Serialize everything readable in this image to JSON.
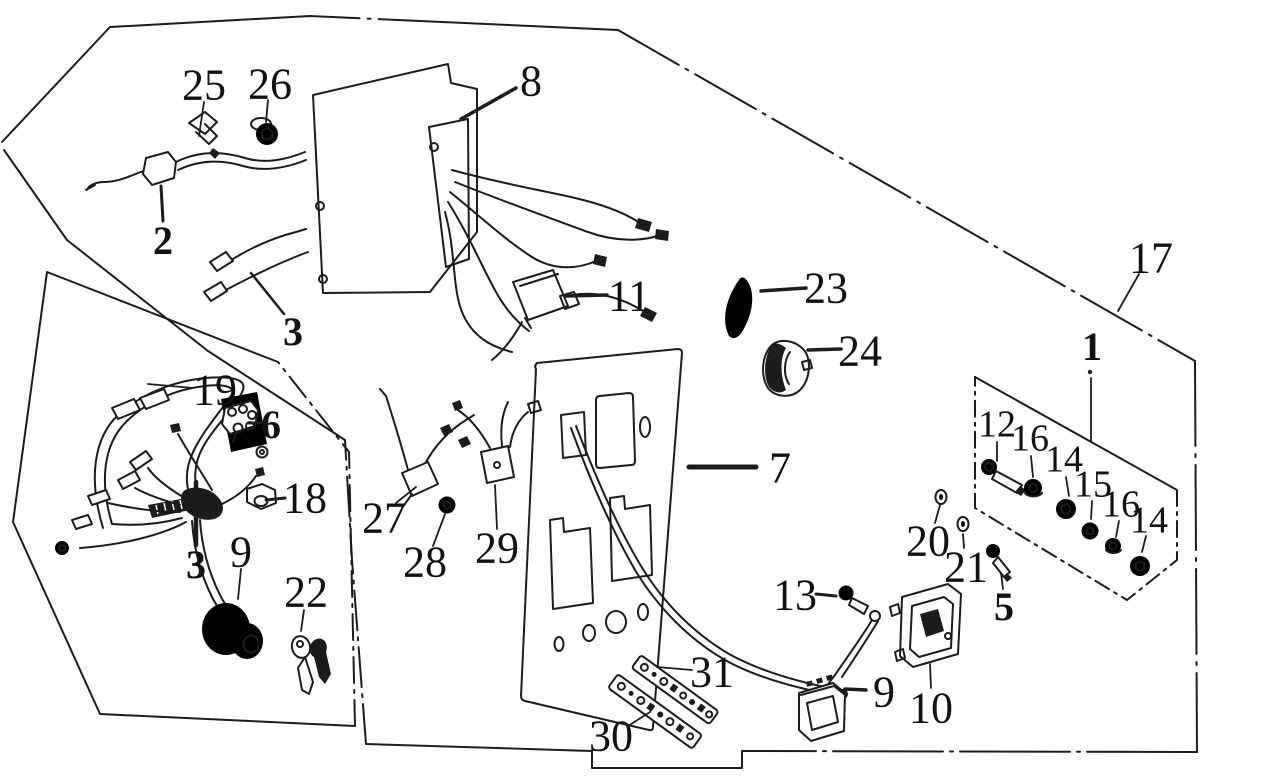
{
  "canvas": {
    "width": 1262,
    "height": 781,
    "background_color": "#ffffff",
    "ink_color": "#1c1c1c"
  },
  "labels": [
    {
      "text": "25",
      "x": 204,
      "y": 84,
      "style": "lg",
      "leader": {
        "x1": 204,
        "y1": 102,
        "x2": 199,
        "y2": 136,
        "w": 1.8
      }
    },
    {
      "text": "26",
      "x": 270,
      "y": 83,
      "style": "lg",
      "leader": {
        "x1": 268,
        "y1": 100,
        "x2": 266,
        "y2": 122,
        "w": 1.8
      }
    },
    {
      "text": "8",
      "x": 531,
      "y": 80,
      "style": "lg",
      "leader": {
        "x1": 516,
        "y1": 88,
        "x2": 461,
        "y2": 119,
        "w": 3.5
      }
    },
    {
      "text": "2",
      "x": 163,
      "y": 240,
      "style": "b",
      "leader": {
        "x1": 163,
        "y1": 221,
        "x2": 161,
        "y2": 186,
        "w": 3
      }
    },
    {
      "text": "3",
      "x": 293,
      "y": 331,
      "style": "b",
      "leader": {
        "x1": 284,
        "y1": 314,
        "x2": 251,
        "y2": 273,
        "w": 2.5
      }
    },
    {
      "text": "11",
      "x": 629,
      "y": 295,
      "style": "lg",
      "leader": {
        "x1": 607,
        "y1": 295,
        "x2": 565,
        "y2": 296,
        "w": 3.5
      }
    },
    {
      "text": "23",
      "x": 826,
      "y": 287,
      "style": "lg",
      "leader": {
        "x1": 806,
        "y1": 288,
        "x2": 761,
        "y2": 291,
        "w": 3.5
      }
    },
    {
      "text": "24",
      "x": 860,
      "y": 350,
      "style": "lg",
      "leader": {
        "x1": 841,
        "y1": 349,
        "x2": 808,
        "y2": 350,
        "w": 3.5
      }
    },
    {
      "text": "17",
      "x": 1151,
      "y": 257,
      "style": "lg",
      "leader": {
        "x1": 1139,
        "y1": 274,
        "x2": 1118,
        "y2": 311,
        "w": 1.8
      }
    },
    {
      "text": "1",
      "x": 1092,
      "y": 346,
      "style": "b",
      "dot": {
        "x": 1090,
        "y": 372
      },
      "leader": {
        "x1": 1091,
        "y1": 378,
        "x2": 1091,
        "y2": 441,
        "w": 1.8
      }
    },
    {
      "text": "19",
      "x": 215,
      "y": 389,
      "style": "lg",
      "leader": {
        "x1": 193,
        "y1": 388,
        "x2": 148,
        "y2": 384,
        "w": 1.8
      }
    },
    {
      "text": "6",
      "x": 271,
      "y": 424,
      "style": "b",
      "leader": {
        "x1": 249,
        "y1": 423,
        "x2": 261,
        "y2": 423,
        "w": 3
      }
    },
    {
      "text": "18",
      "x": 305,
      "y": 497,
      "style": "lg",
      "leader": {
        "x1": 285,
        "y1": 498,
        "x2": 266,
        "y2": 500,
        "w": 3
      }
    },
    {
      "text": "3",
      "x": 196,
      "y": 564,
      "style": "b",
      "leader": {
        "x1": 196,
        "y1": 545,
        "x2": 196,
        "y2": 482,
        "w": 4.5
      }
    },
    {
      "text": "9",
      "x": 241,
      "y": 551,
      "style": "lg",
      "leader": {
        "x1": 241,
        "y1": 569,
        "x2": 238,
        "y2": 599,
        "w": 1.8
      }
    },
    {
      "text": "22",
      "x": 306,
      "y": 591,
      "style": "lg",
      "leader": {
        "x1": 304,
        "y1": 610,
        "x2": 301,
        "y2": 631,
        "w": 1.8
      }
    },
    {
      "text": "27",
      "x": 384,
      "y": 517,
      "style": "lg",
      "leader": {
        "x1": 396,
        "y1": 503,
        "x2": 416,
        "y2": 487,
        "w": 1.8
      }
    },
    {
      "text": "28",
      "x": 425,
      "y": 561,
      "style": "lg",
      "leader": {
        "x1": 433,
        "y1": 546,
        "x2": 445,
        "y2": 514,
        "w": 1.8
      }
    },
    {
      "text": "29",
      "x": 497,
      "y": 547,
      "style": "lg",
      "leader": {
        "x1": 497,
        "y1": 529,
        "x2": 495,
        "y2": 485,
        "w": 1.8
      }
    },
    {
      "text": "7",
      "x": 780,
      "y": 467,
      "style": "lg",
      "leader": {
        "x1": 756,
        "y1": 467,
        "x2": 689,
        "y2": 467,
        "w": 5
      }
    },
    {
      "text": "31",
      "x": 712,
      "y": 671,
      "style": "lg",
      "leader": {
        "x1": 692,
        "y1": 670,
        "x2": 657,
        "y2": 667,
        "w": 1.8
      }
    },
    {
      "text": "30",
      "x": 611,
      "y": 735,
      "style": "lg",
      "leader": {
        "x1": 628,
        "y1": 726,
        "x2": 650,
        "y2": 712,
        "w": 1.8
      }
    },
    {
      "text": "13",
      "x": 795,
      "y": 594,
      "style": "lg",
      "leader": {
        "x1": 816,
        "y1": 594,
        "x2": 836,
        "y2": 596,
        "w": 3
      }
    },
    {
      "text": "9",
      "x": 884,
      "y": 691,
      "style": "lg",
      "leader": {
        "x1": 866,
        "y1": 690,
        "x2": 845,
        "y2": 689,
        "w": 3.5
      }
    },
    {
      "text": "10",
      "x": 931,
      "y": 707,
      "style": "lg",
      "leader": {
        "x1": 931,
        "y1": 688,
        "x2": 930,
        "y2": 664,
        "w": 1.8
      }
    },
    {
      "text": "20",
      "x": 928,
      "y": 540,
      "style": "lg",
      "leader": {
        "x1": 935,
        "y1": 523,
        "x2": 940,
        "y2": 505,
        "w": 1.8
      }
    },
    {
      "text": "21",
      "x": 966,
      "y": 566,
      "style": "lg",
      "leader": {
        "x1": 964,
        "y1": 548,
        "x2": 963,
        "y2": 534,
        "w": 1.8
      }
    },
    {
      "text": "5",
      "x": 1004,
      "y": 606,
      "style": "b",
      "leader": {
        "x1": 1003,
        "y1": 589,
        "x2": 1001,
        "y2": 573,
        "w": 1.8
      }
    },
    {
      "text": "12",
      "x": 997,
      "y": 423,
      "style": "sm",
      "leader": {
        "x1": 997,
        "y1": 442,
        "x2": 997,
        "y2": 461,
        "w": 1.8
      }
    },
    {
      "text": "16",
      "x": 1030,
      "y": 437,
      "style": "sm",
      "leader": {
        "x1": 1031,
        "y1": 456,
        "x2": 1033,
        "y2": 477,
        "w": 1.8
      }
    },
    {
      "text": "14",
      "x": 1064,
      "y": 458,
      "style": "sm",
      "leader": {
        "x1": 1066,
        "y1": 477,
        "x2": 1069,
        "y2": 496,
        "w": 1.8
      }
    },
    {
      "text": "15",
      "x": 1093,
      "y": 483,
      "style": "sm",
      "leader": {
        "x1": 1092,
        "y1": 501,
        "x2": 1091,
        "y2": 519,
        "w": 1.8
      }
    },
    {
      "text": "16",
      "x": 1121,
      "y": 503,
      "style": "sm",
      "leader": {
        "x1": 1119,
        "y1": 521,
        "x2": 1116,
        "y2": 537,
        "w": 1.8
      }
    },
    {
      "text": "14",
      "x": 1149,
      "y": 519,
      "style": "sm",
      "leader": {
        "x1": 1146,
        "y1": 536,
        "x2": 1142,
        "y2": 552,
        "w": 1.8
      }
    }
  ]
}
